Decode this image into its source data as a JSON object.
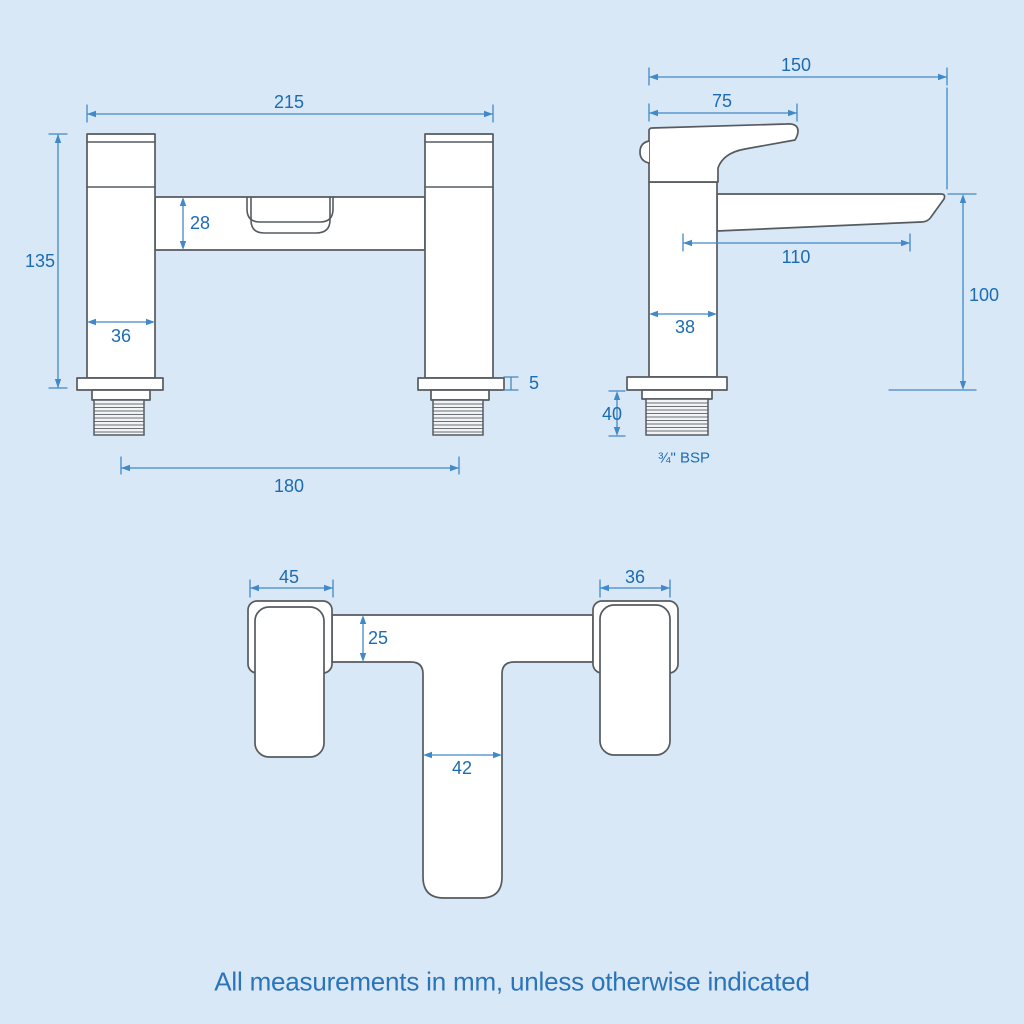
{
  "caption": "All measurements in mm, unless otherwise indicated",
  "units": "mm",
  "dims": {
    "front": {
      "overall_width": "215",
      "overall_height": "135",
      "bar_height": "28",
      "pillar_width": "36",
      "base_plate_thickness": "5",
      "tail_centres": "180"
    },
    "side": {
      "overall_depth": "150",
      "handle_length": "75",
      "spout_reach": "110",
      "body_depth": "38",
      "spout_height": "100",
      "tail_length": "40",
      "thread_spec": "¾\" BSP"
    },
    "plan": {
      "handle_width": "45",
      "lever_width": "36",
      "bar_depth": "25",
      "spout_width": "42"
    }
  },
  "colors": {
    "background": "#d9e8f6",
    "outline": "#555b60",
    "dimension_line": "#4189c9",
    "dimension_text": "#1b6cb4",
    "caption_text": "#2b74ba",
    "fill": "#ffffff"
  }
}
